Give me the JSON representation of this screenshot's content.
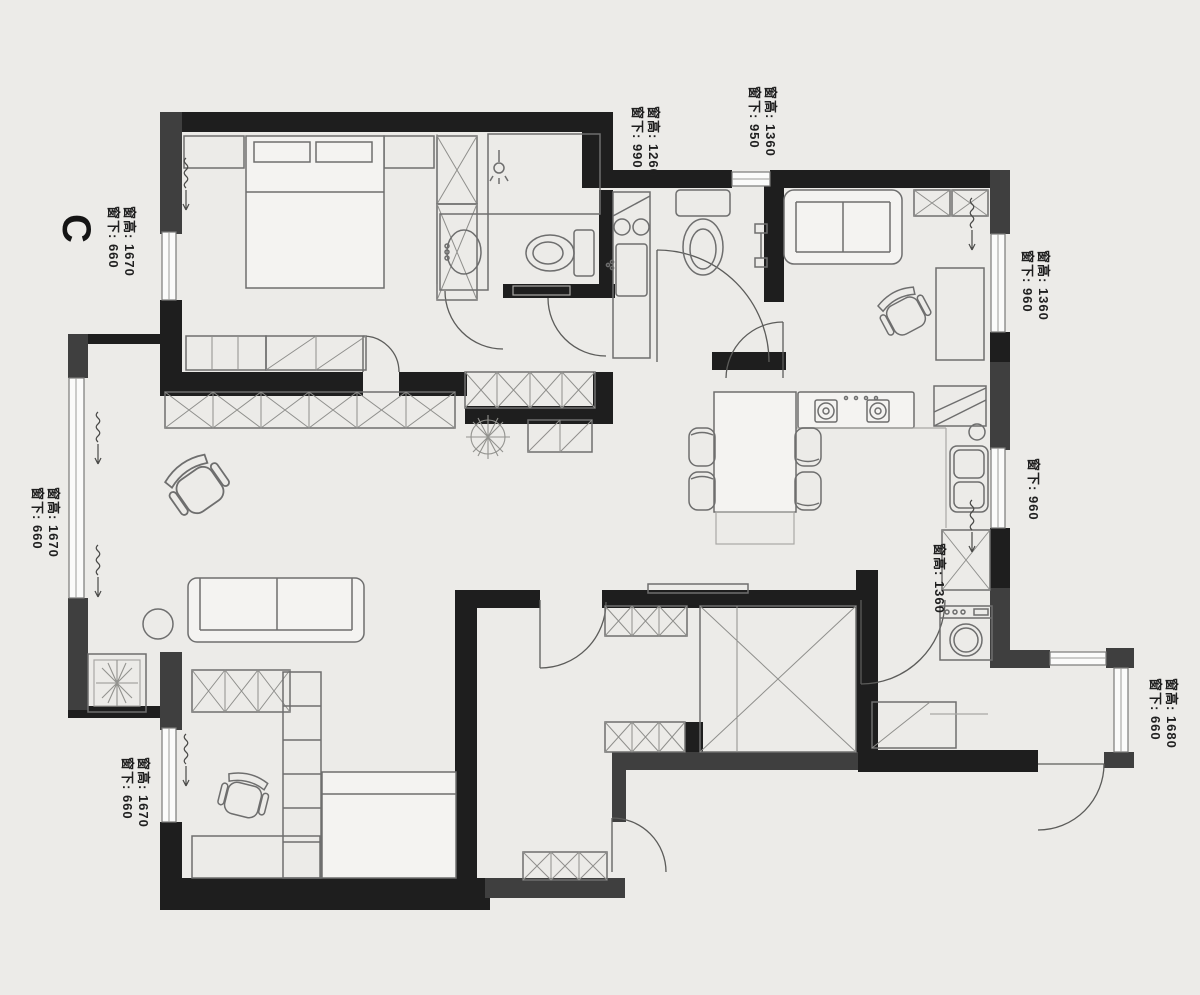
{
  "plan_letter": {
    "text": "C"
  },
  "annotations": {
    "bath_north_window": {
      "line1": "窗高: 1260",
      "line2": "窗下: 990"
    },
    "hall_north_window": {
      "line1": "窗高: 1360",
      "line2": "窗下: 950"
    },
    "master_west_window": {
      "line1": "窗高: 1670",
      "line2": "窗下: 660"
    },
    "study_east_window": {
      "line1": "窗高: 1360",
      "line2": "窗下: 960"
    },
    "kitchen_east_window": {
      "line1": "窗下: 960"
    },
    "living_west_window": {
      "line1": "窗高: 1670",
      "line2": "窗下: 660"
    },
    "laundry_window": {
      "line1": "窗高: 1360"
    },
    "balcony_east_window": {
      "line1": "窗高: 1680",
      "line2": "窗下: 660"
    },
    "bedroom_west_window": {
      "line1": "窗高: 1670",
      "line2": "窗下: 660"
    }
  },
  "colors": {
    "background": "#ecebe8",
    "wall_primary": "#1e1e1e",
    "wall_secondary": "#3f3f3f",
    "furniture_line": "#6e6e6e",
    "window_fill": "#fbfbfa",
    "annotation_text": "#1f1f1f"
  },
  "furniture_icons": [
    "double-bed-icon",
    "nightstand-icon",
    "wardrobe-icon",
    "sliding-wardrobe-icon",
    "storage-cabinet-icon",
    "shower-icon",
    "bathroom-sink-icon",
    "toilet-icon",
    "kitchen-counter-icon",
    "stove-burner-icon",
    "kitchen-sink-icon",
    "fridge-icon",
    "dining-table-icon",
    "dining-chair-icon",
    "sofa-icon",
    "armchair-icon",
    "office-chair-icon",
    "desk-icon",
    "bookshelf-icon",
    "round-table-icon",
    "plant-icon",
    "planter-icon",
    "washing-machine-icon",
    "walk-in-closet-icon",
    "shoe-cabinet-icon",
    "bench-icon",
    "window-icon",
    "door-icon"
  ]
}
